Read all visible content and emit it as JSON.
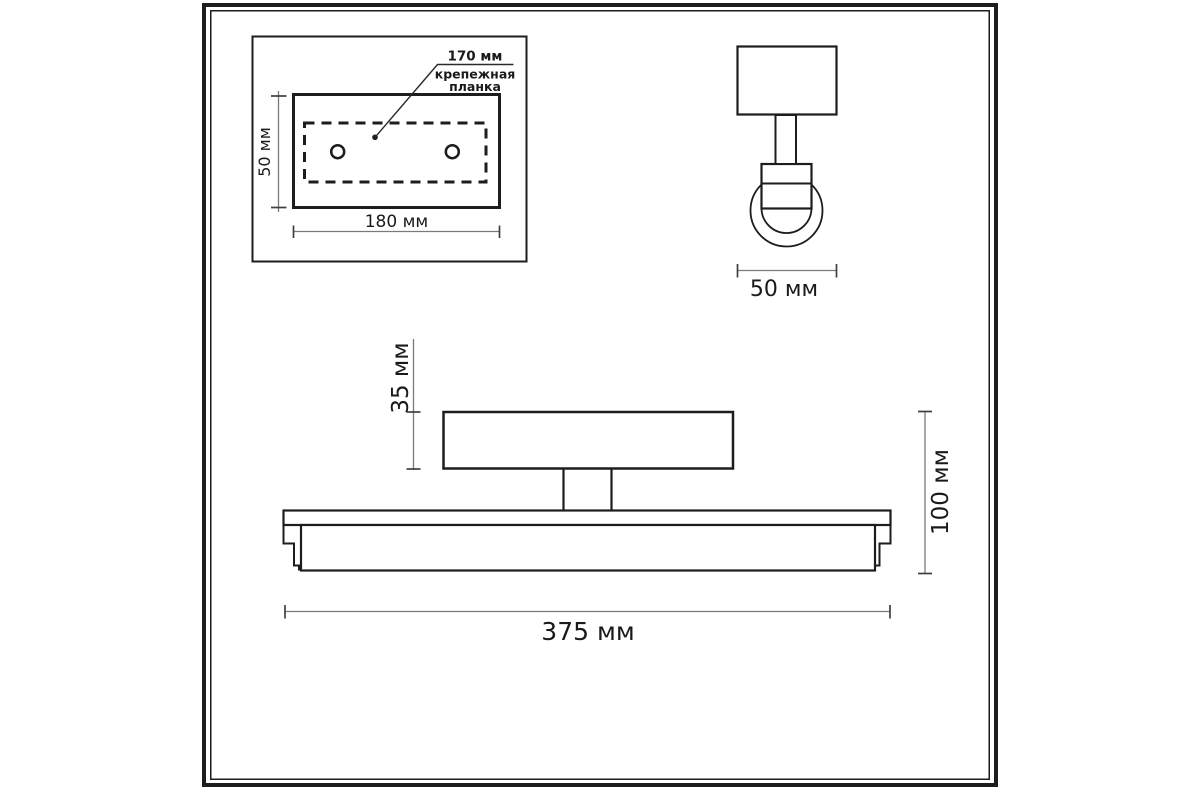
{
  "drawing_type": "technical dimension drawing of a wall light fixture",
  "colors": {
    "background": "#ffffff",
    "outline": "#1d1d1b",
    "dimension_line": "#7a7a7a",
    "tick": "#3f3f3f",
    "text": "#1a1a1a"
  },
  "views": {
    "mounting_plate": {
      "name": "mounting plate plan view (top-left inset)",
      "labels": {
        "inner_width": "170 мм",
        "part_line1": "крепежная",
        "part_line2": "планка",
        "height": "50 мм",
        "width": "180 мм"
      }
    },
    "side_view": {
      "name": "fixture side view (top-right)",
      "labels": {
        "depth": "50 мм"
      }
    },
    "front_view": {
      "name": "fixture front view (bottom)",
      "labels": {
        "backplate_height": "35 мм",
        "total_height": "100 мм",
        "total_width": "375 мм"
      }
    }
  }
}
